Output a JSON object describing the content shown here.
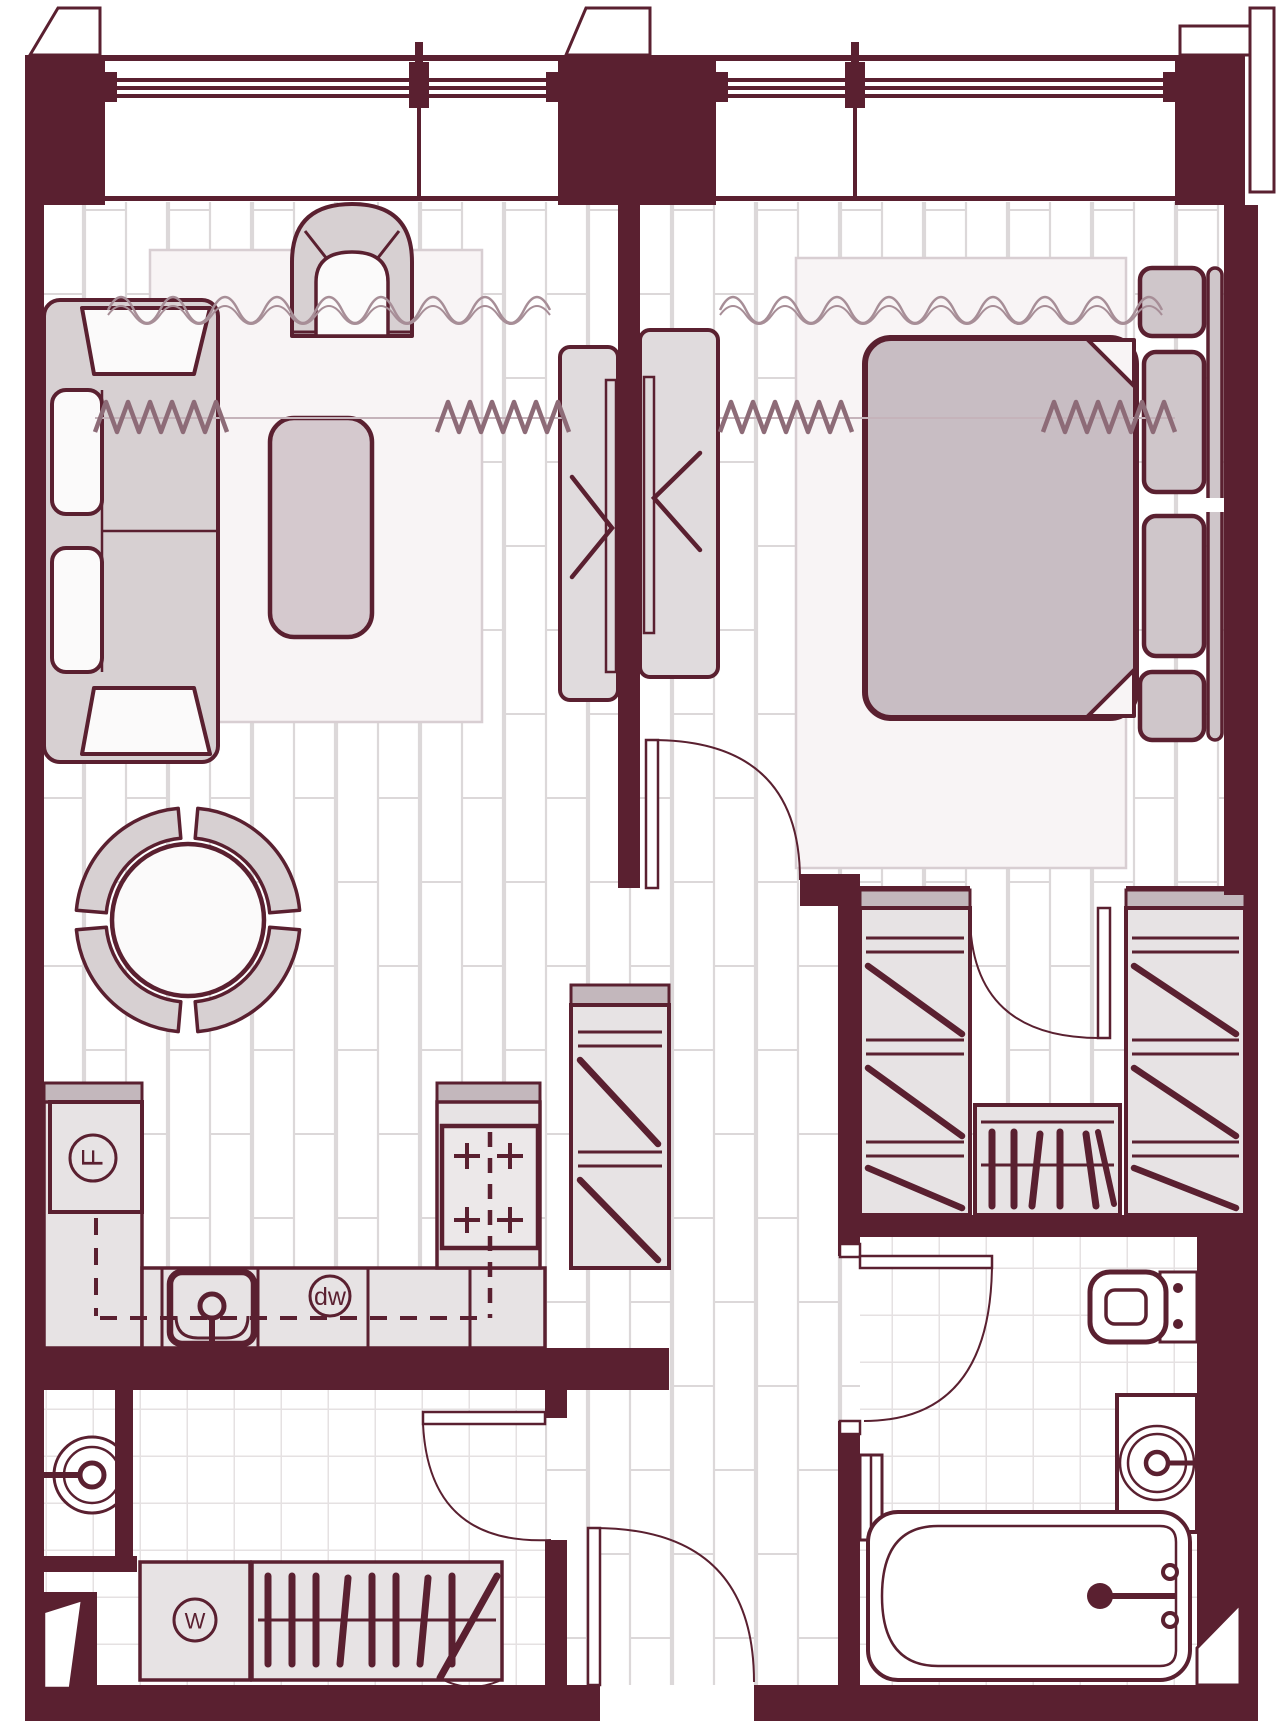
{
  "labels": {
    "fridge": "F",
    "dishwasher": "dw",
    "washer": "W"
  },
  "colors": {
    "wall": "#5a2030",
    "line": "#5a2030",
    "counter_fill": "#e7e3e4",
    "counter_band": "#c3b7bc",
    "sofa_fill": "#d7d0d2",
    "cushion_fill": "#fbfafa",
    "duvet_fill": "#c8bdc3",
    "pillow_fill": "#cfc6ca",
    "table_fill": "#d5c9ce",
    "console_fill": "#e0dbdd",
    "rug_fill": "#f8f4f5",
    "rug_edge": "#d8ced2",
    "plank_line": "#dcd8d9",
    "tile_line": "#e5e1e2",
    "curtain_sheer": "#a78e97",
    "curtain_drape": "#8d6b77"
  },
  "fixtures": [
    "window",
    "curtain",
    "sofa",
    "armchair",
    "coffee-table",
    "rug",
    "dining-table",
    "dining-chair",
    "tv-console",
    "double-bed",
    "nightstand",
    "pillow",
    "wardrobe",
    "shelving-unit",
    "fridge",
    "hob",
    "kitchen-sink",
    "dishwasher",
    "washing-machine",
    "utility-sink",
    "toilet",
    "vanity-basin",
    "bathtub",
    "towel-rail",
    "door"
  ]
}
